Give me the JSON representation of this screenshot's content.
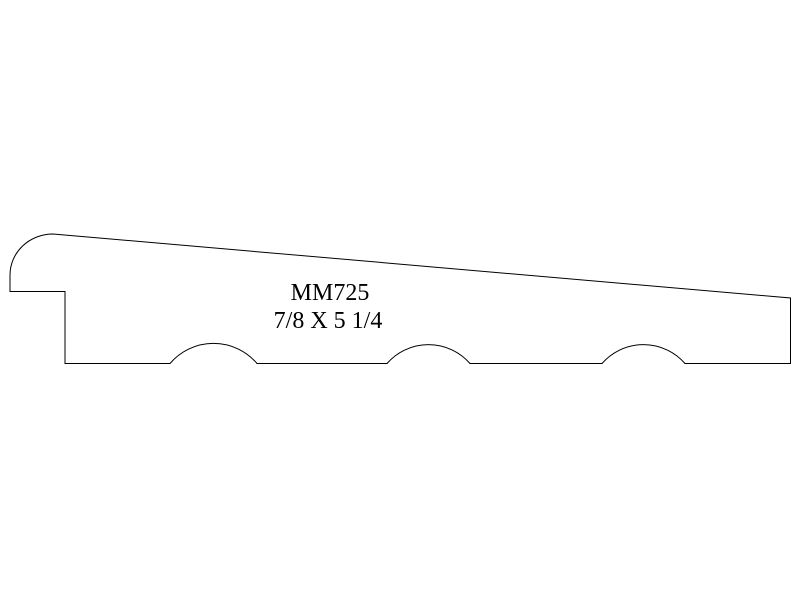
{
  "drawing": {
    "part_number": "MM725",
    "dimensions": "7/8 X 5 1/4",
    "type": "moulding-profile-cross-section",
    "colors": {
      "line": "#000000",
      "background": "#ffffff",
      "text": "#000000"
    }
  }
}
